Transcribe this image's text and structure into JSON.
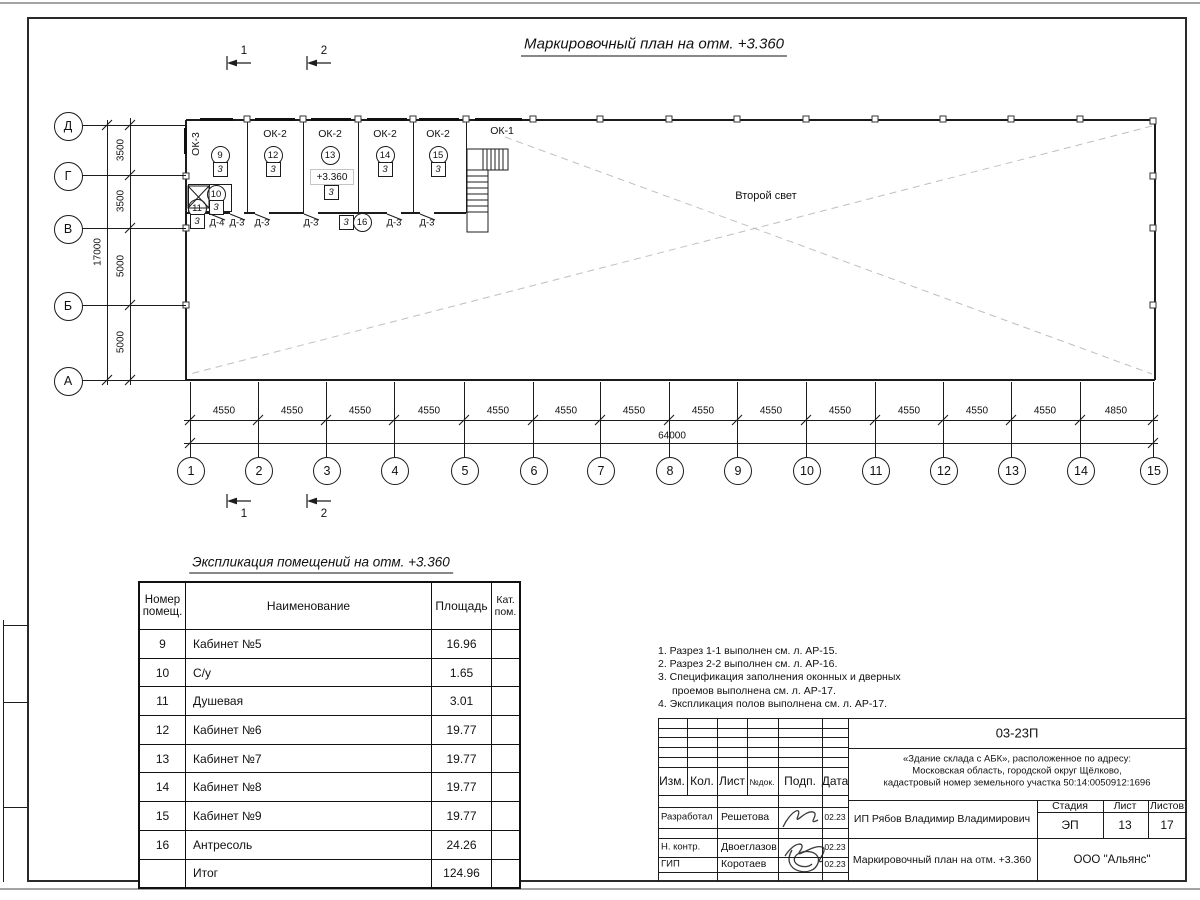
{
  "sheet": {
    "plan_title": "Маркировочный план на отм. +3.360",
    "second_light": "Второй свет",
    "level_mark": "+3.360"
  },
  "plan": {
    "row_axes": [
      "Д",
      "Г",
      "В",
      "Б",
      "А"
    ],
    "col_axes": [
      "1",
      "2",
      "3",
      "4",
      "5",
      "6",
      "7",
      "8",
      "9",
      "10",
      "11",
      "12",
      "13",
      "14",
      "15"
    ],
    "v_dims": [
      "3500",
      "3500",
      "5000",
      "5000"
    ],
    "v_total": "17000",
    "h_dims": [
      "4550",
      "4550",
      "4550",
      "4550",
      "4550",
      "4550",
      "4550",
      "4550",
      "4550",
      "4550",
      "4550",
      "4550",
      "4550",
      "4850"
    ],
    "h_total": "64000",
    "window_marks": [
      "ОК-3",
      "ОК-2",
      "ОК-2",
      "ОК-2",
      "ОК-2",
      "ОК-1"
    ],
    "room_numbers": [
      "9",
      "12",
      "13",
      "14",
      "15",
      "10",
      "11",
      "16"
    ],
    "floor_type_marks": [
      "3",
      "3",
      "3",
      "3",
      "3",
      "3",
      "3",
      "3"
    ],
    "door_marks": [
      "Д-4",
      "Д-3",
      "Д-3",
      "Д-3",
      "Д-3",
      "Д-3"
    ],
    "section_marks": [
      "1",
      "2"
    ]
  },
  "explication": {
    "title": "Экспликация помещений на отм. +3.360",
    "headers": [
      "Номер помещ.",
      "Наименование",
      "Площадь",
      "Кат. пом."
    ],
    "rows": [
      [
        "9",
        "Кабинет №5",
        "16.96",
        ""
      ],
      [
        "10",
        "С/у",
        "1.65",
        ""
      ],
      [
        "11",
        "Душевая",
        "3.01",
        ""
      ],
      [
        "12",
        "Кабинет №6",
        "19.77",
        ""
      ],
      [
        "13",
        "Кабинет №7",
        "19.77",
        ""
      ],
      [
        "14",
        "Кабинет №8",
        "19.77",
        ""
      ],
      [
        "15",
        "Кабинет №9",
        "19.77",
        ""
      ],
      [
        "16",
        "Антресоль",
        "24.26",
        ""
      ],
      [
        "",
        "Итог",
        "124.96",
        ""
      ]
    ]
  },
  "notes": {
    "lines": [
      "1. Разрез 1-1 выполнен см. л. АР-15.",
      "2. Разрез 2-2 выполнен см. л. АР-16.",
      "3. Спецификация заполнения оконных и дверных",
      "проемов выполнена см. л. АР-17.",
      "4. Экспликация полов выполнена см. л. АР-17."
    ]
  },
  "titleblock": {
    "doc_number": "03-23П",
    "address_lines": [
      "«Здание склада с АБК», расположенное по адресу:",
      "Московская область, городской округ Щёлково,",
      "кадастровый номер земельного участка 50:14:0050912:1696"
    ],
    "col_izm": "Изм.",
    "col_kol": "Кол.",
    "col_list": "Лист",
    "col_ndok": "№док.",
    "col_podp": "Подп.",
    "col_data": "Дата",
    "roles": [
      {
        "role": "Разработал",
        "name": "Решетова",
        "date": "02.23"
      },
      {
        "role": "Н. контр.",
        "name": "Двоеглазов",
        "date": "02.23"
      },
      {
        "role": "ГИП",
        "name": "Коротаев",
        "date": "02.23"
      }
    ],
    "client": "ИП Рябов Владимир Владимирович",
    "stage_label": "Стадия",
    "sheet_label": "Лист",
    "sheets_label": "Листов",
    "stage": "ЭП",
    "sheet_no": "13",
    "sheets_total": "17",
    "drawing_name": "Маркировочный план на отм. +3.360",
    "company": "ООО \"Альянс\""
  }
}
